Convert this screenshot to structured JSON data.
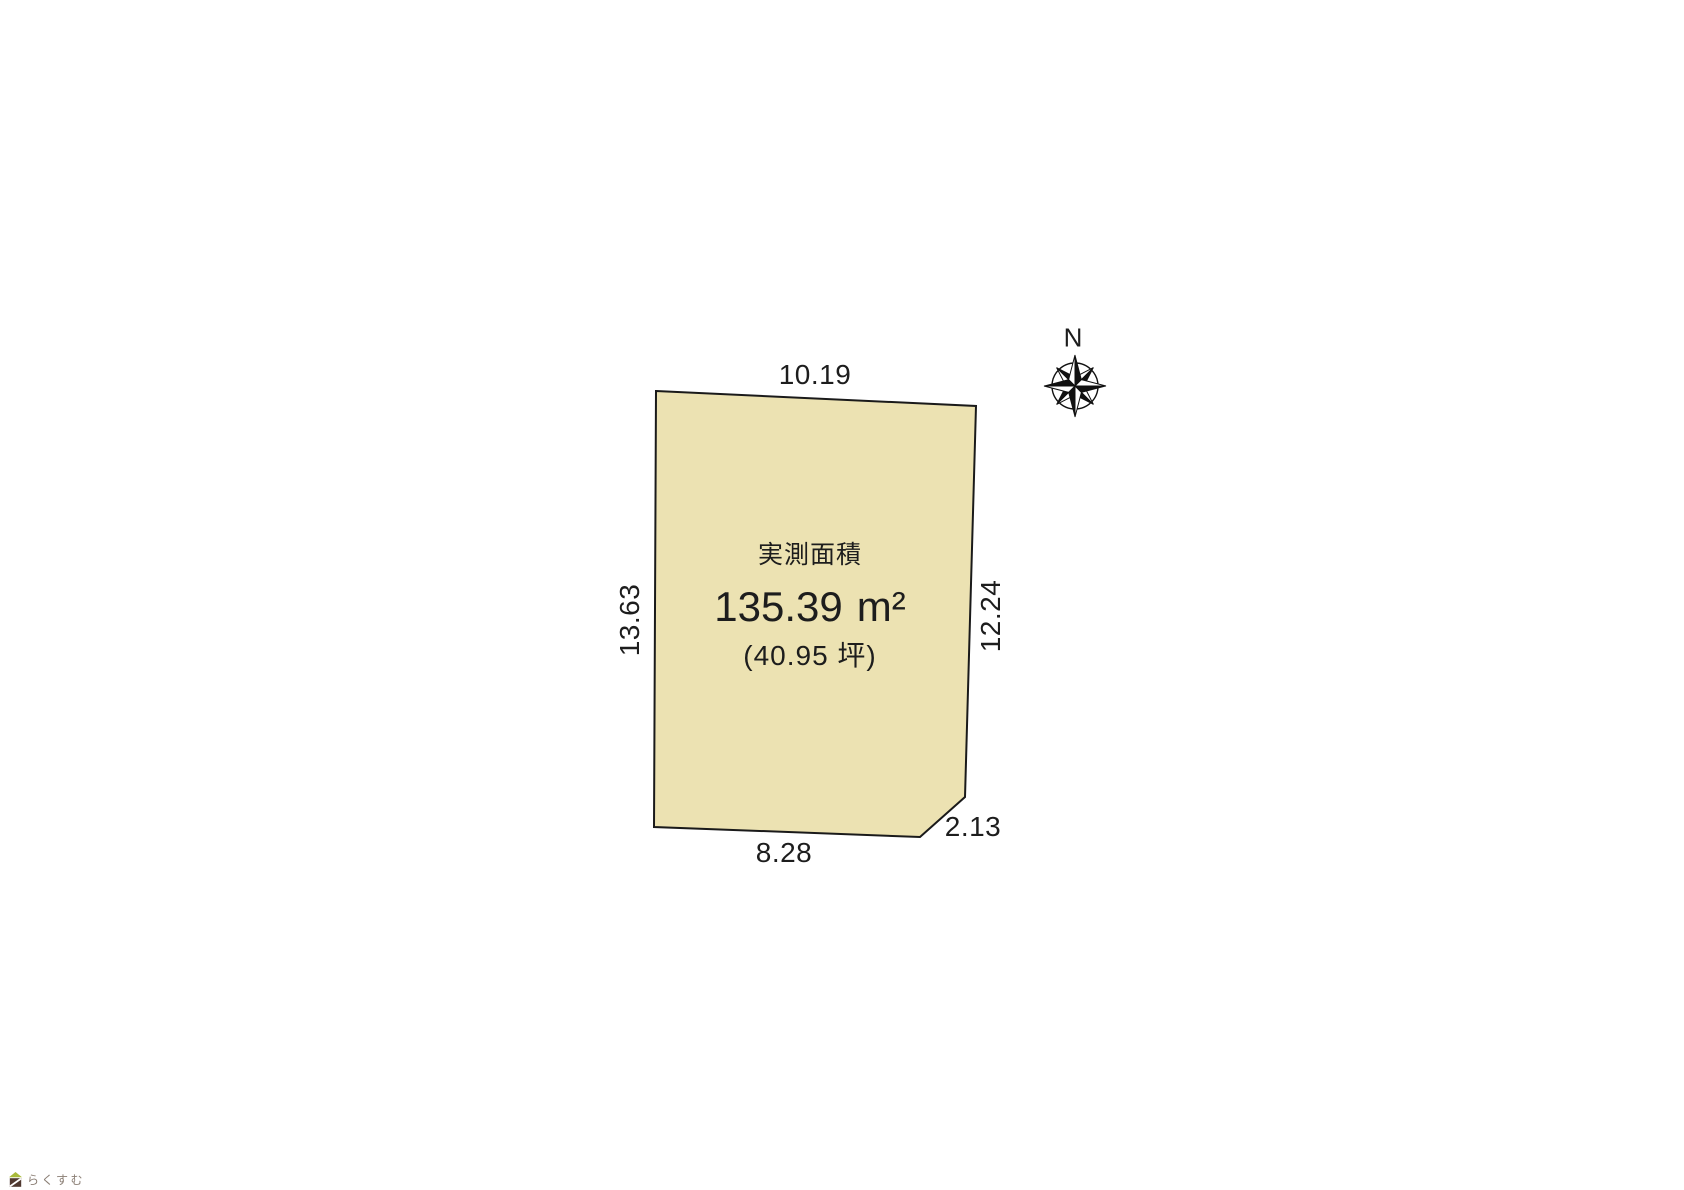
{
  "colors": {
    "plot_fill": "#ece2b2",
    "plot_stroke": "#1a1a1a",
    "text": "#1d1d1d",
    "logo_roof": "#a9ba3a",
    "logo_body": "#503930",
    "logo_text": "#8a7e74"
  },
  "plot": {
    "area_title": "実測面積",
    "area_value": "135.39",
    "area_unit": "m²",
    "area_tsubo": "(40.95 坪)",
    "dimensions": {
      "top": "10.19",
      "left": "13.63",
      "right": "12.24",
      "bottom": "8.28",
      "corner": "2.13"
    }
  },
  "compass": {
    "north_label": "N"
  },
  "logo": {
    "text": "らくすむ"
  }
}
